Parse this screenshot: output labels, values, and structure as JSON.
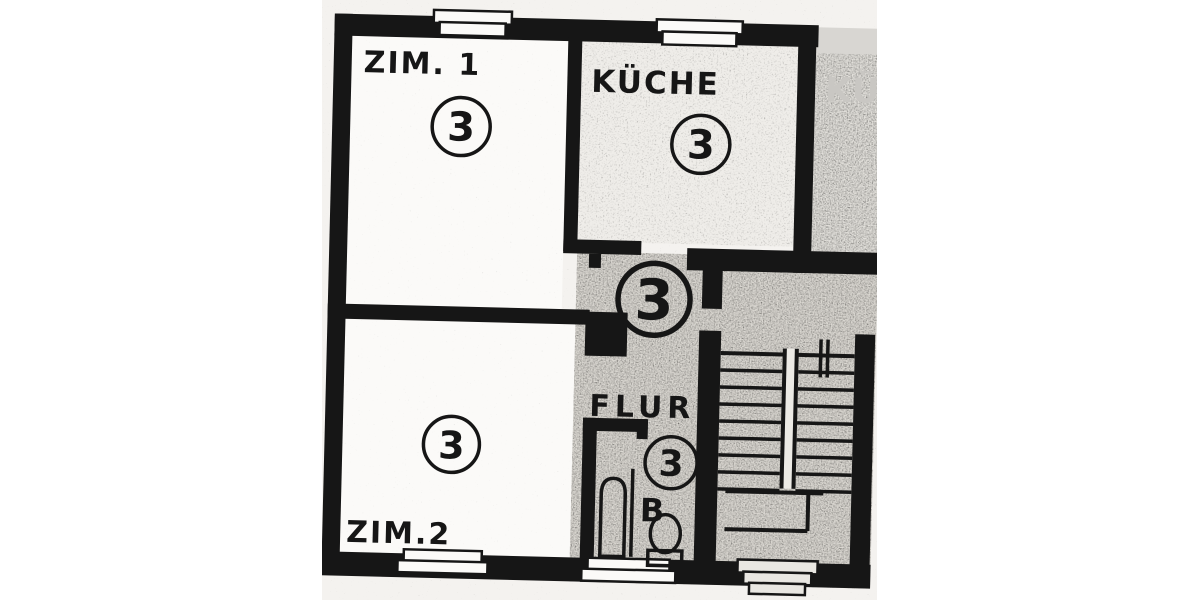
{
  "document": {
    "type_label": "apartment floor plan scan"
  },
  "rooms": {
    "zim1": {
      "label": "ZIM. 1",
      "number": "3"
    },
    "kueche": {
      "label": "KÜCHE",
      "number": "3"
    },
    "zim2": {
      "label": "ZIM.2",
      "number": "3"
    },
    "flur": {
      "label": "FLUR",
      "number": "3"
    }
  },
  "hallway": {
    "number": "3"
  },
  "bathroom": {
    "boiler_label": "B"
  },
  "adjacent_unit": {
    "faded_label": "KÜC"
  },
  "colors": {
    "ink": "#161616",
    "paper": "#ffffff",
    "scan_tint": "#f4f2ef",
    "stair_tint": "#dcd9d3",
    "faded_text": "#c9c7c3"
  }
}
